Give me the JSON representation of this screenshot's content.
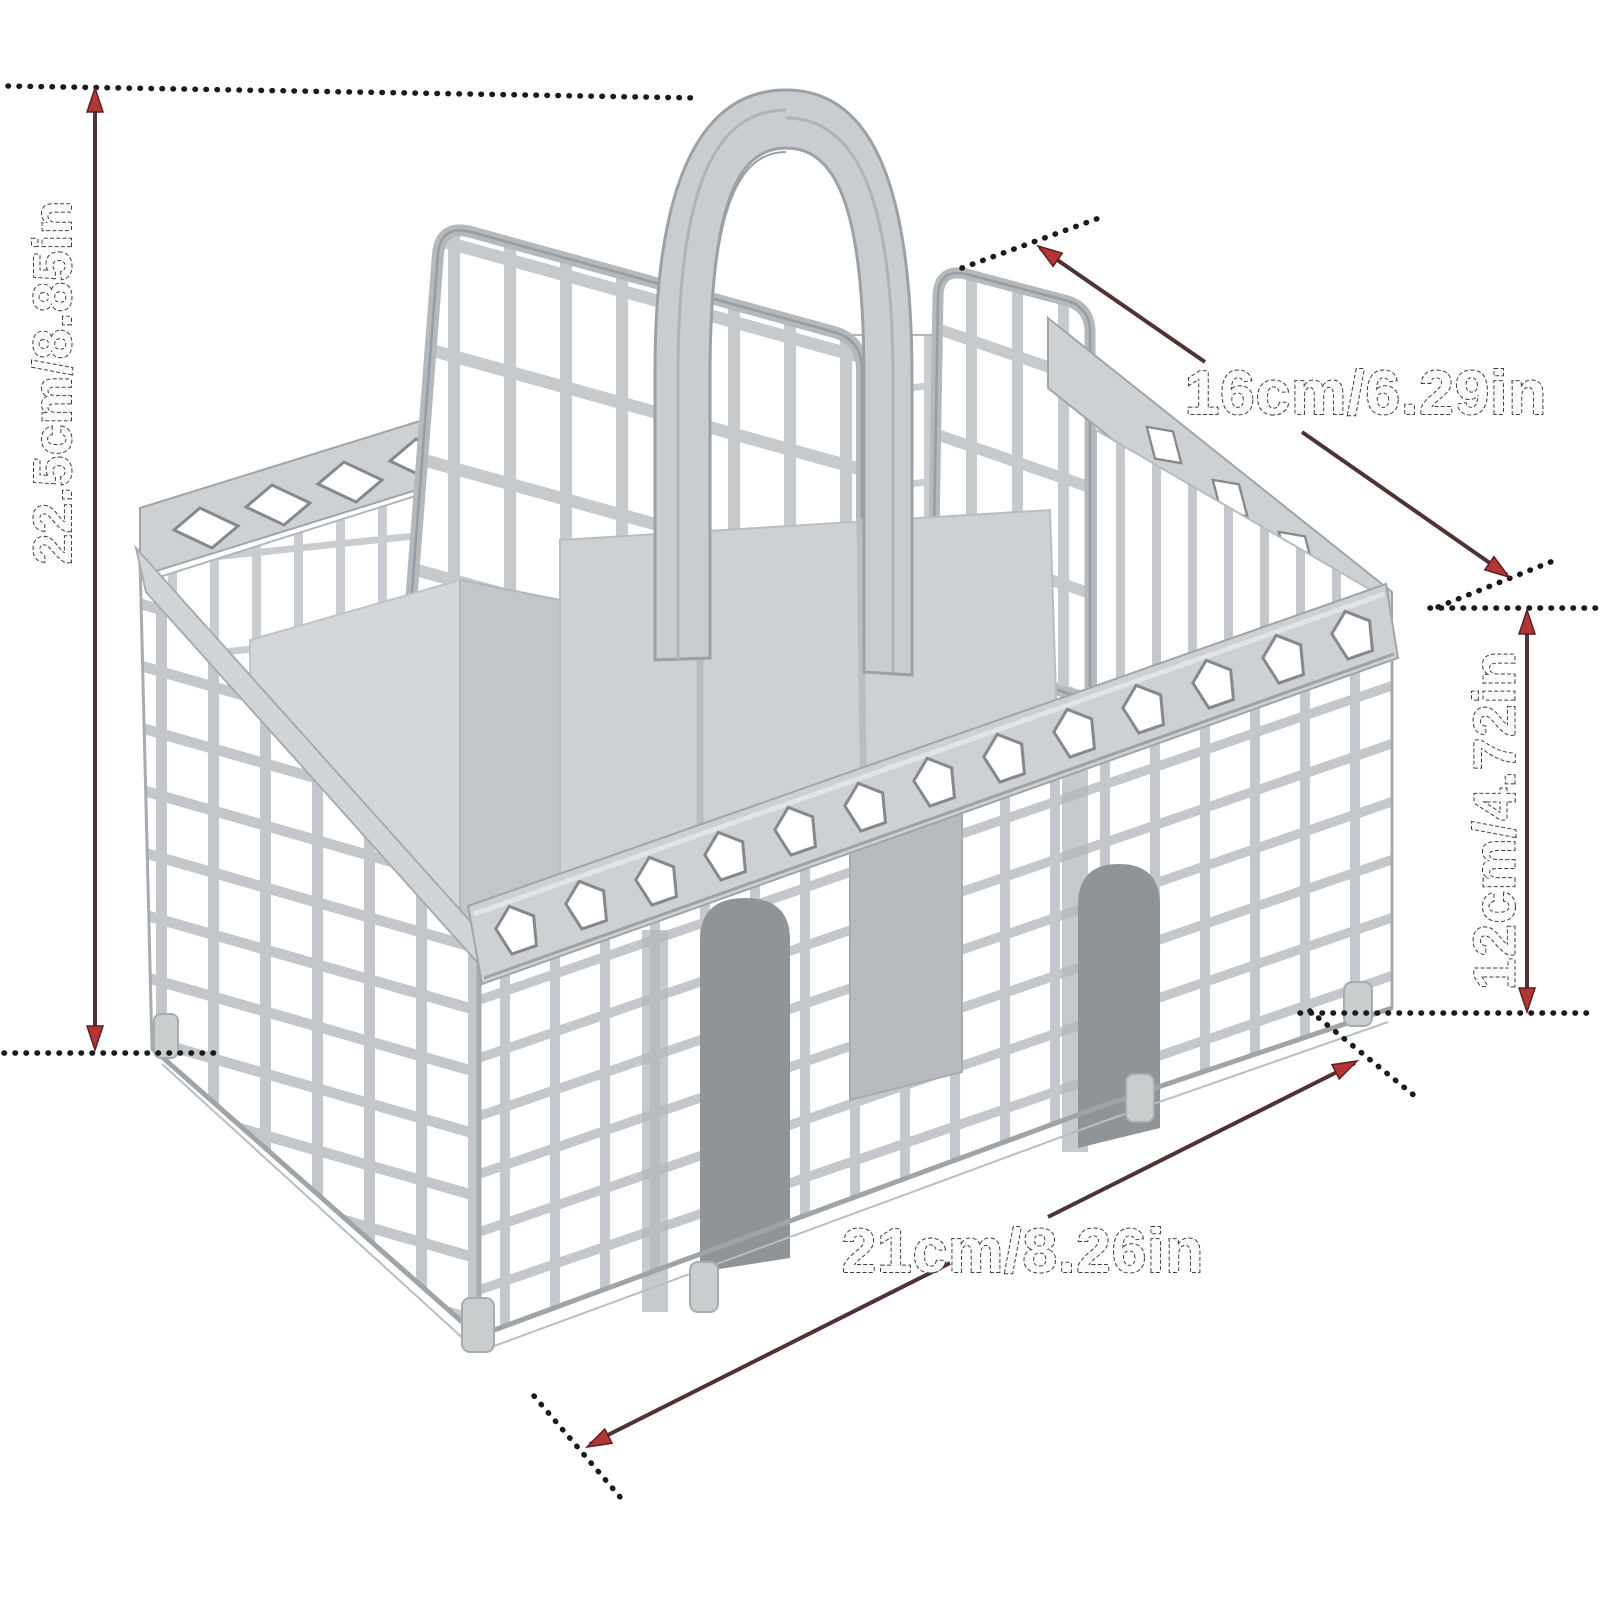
{
  "product_diagram": {
    "item_name": "dishwasher-cutlery-basket",
    "background": "#ffffff",
    "dimensions": {
      "height": {
        "label": "22.5cm/8.85in",
        "orientation": "vertical-left"
      },
      "top_depth": {
        "label": "16cm/6.29in",
        "orientation": "diagonal-top-right"
      },
      "basket_height": {
        "label": "12cm/4.72in",
        "orientation": "vertical-right"
      },
      "width": {
        "label": "21cm/8.26in",
        "orientation": "diagonal-bottom"
      }
    },
    "colors": {
      "plastic": "#c7cbce",
      "plastic_dark": "#a7acb0",
      "dimension_line": "#4f3334",
      "arrow": "#b23636",
      "dot": "#1b1b1b",
      "label_outline": "#3f3f3f"
    }
  }
}
